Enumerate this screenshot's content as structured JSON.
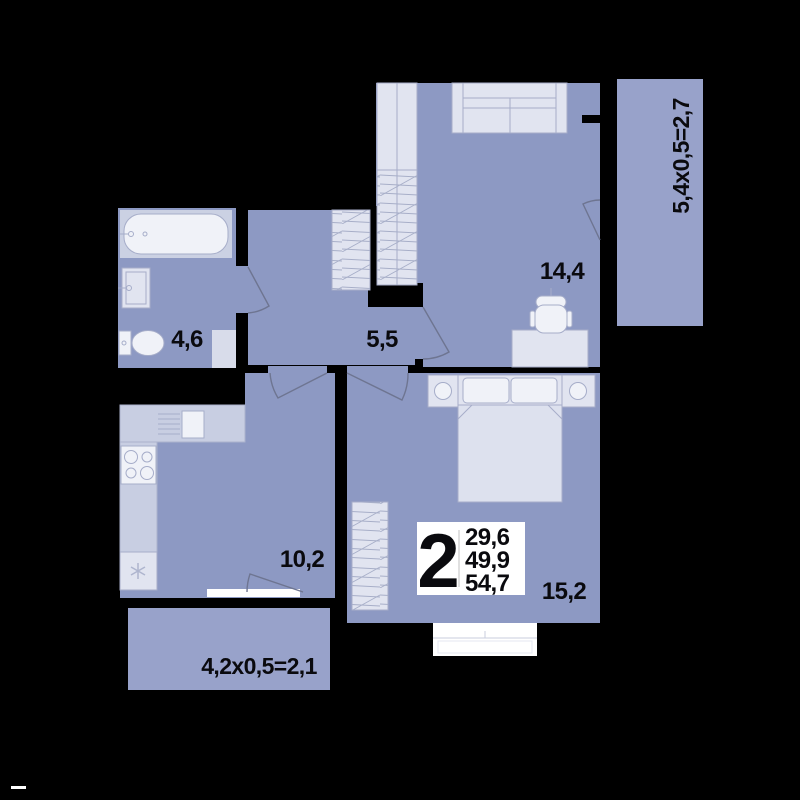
{
  "floor_plan": {
    "room_labels": {
      "living_room": "14,4",
      "hallway": "5,5",
      "bathroom": "4,6",
      "kitchen": "10,2",
      "bedroom": "15,2"
    },
    "loggia_labels": {
      "right": "5,4x0,5=2,7",
      "bottom": "4,2x0,5=2,1"
    },
    "info_badge": {
      "rooms_count": "2",
      "area_lines": [
        "29,6",
        "49,9",
        "54,7"
      ]
    },
    "colors": {
      "background": "#000000",
      "room_fill": "#8D99C3",
      "loggia_fill": "#98A2CA",
      "furniture_fill": "#E1E4F0",
      "wardrobe_fill": "#E6E8F2",
      "badge_background": "#FFFFFF",
      "label_text": "#0A0A0E"
    }
  }
}
